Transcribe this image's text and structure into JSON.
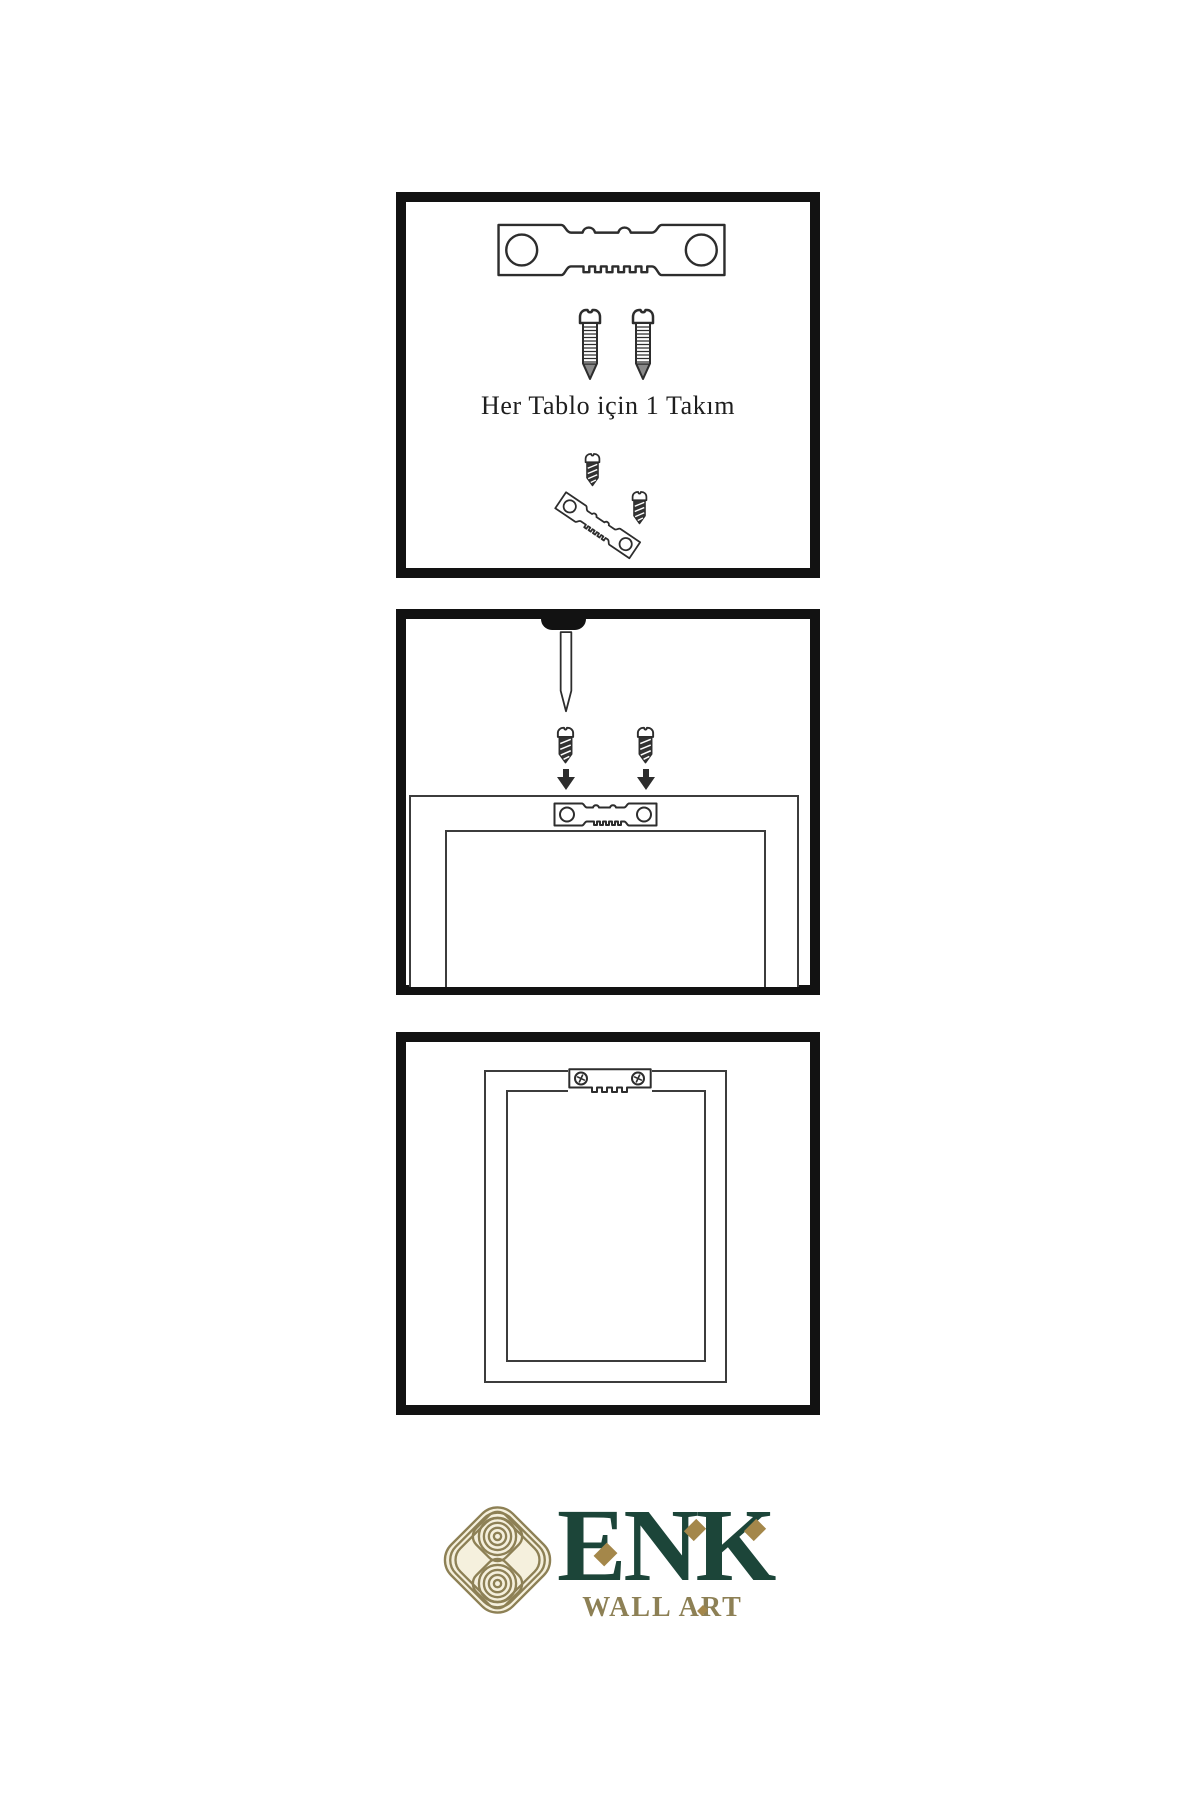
{
  "colors": {
    "background": "#ffffff",
    "ink": "#2d2d2d",
    "panel_border": "#121212",
    "frame_line": "#3c3c3c",
    "screw_dark": "#333333",
    "brand_green": "#1c4539",
    "brand_gold": "#8d8055",
    "diamond_gold": "#a4874a",
    "emblem_cream": "#f5f0dd"
  },
  "panel1": {
    "caption": "Her Tablo için 1 Takım",
    "icons": [
      "sawtooth-hanger-icon",
      "screw-icon",
      "screw-icon",
      "dark-screw-icon",
      "tilted-sawtooth-hanger-icon",
      "dark-screw-icon"
    ]
  },
  "panel2": {
    "icons": [
      "wall-nail-icon",
      "dark-screw-icon",
      "dark-screw-icon",
      "arrow-down-icon",
      "arrow-down-icon",
      "sawtooth-hanger-icon",
      "frame-back-outline"
    ]
  },
  "panel3": {
    "icons": [
      "mounted-sawtooth-hanger-icon",
      "frame-outline"
    ]
  },
  "logo": {
    "brand": "ENK",
    "subtitle": "WALL ART",
    "emblem": "interlaced-knot-emblem-icon"
  }
}
